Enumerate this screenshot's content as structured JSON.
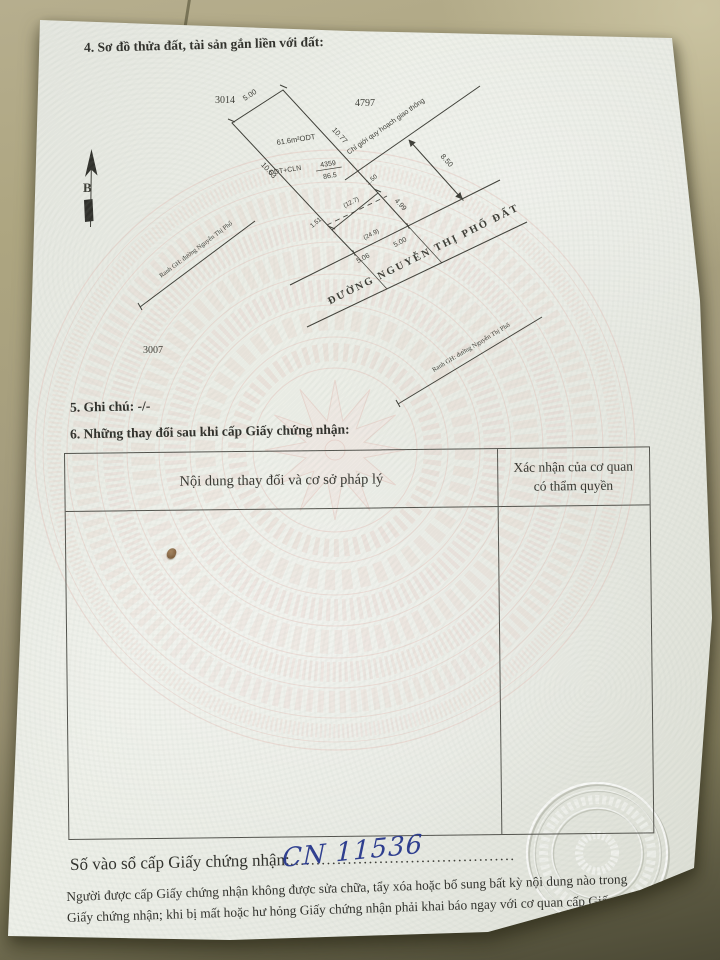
{
  "document": {
    "section4_title": "4. Sơ đồ thửa đất, tài sản gắn liền với đất:",
    "section5_title": "5. Ghi chú: -/-",
    "section6_title": "6. Những thay đổi sau khi cấp Giấy chứng nhận:",
    "table": {
      "col1_header": "Nội dung thay đổi và cơ sở pháp lý",
      "col2_header_line1": "Xác nhận của cơ quan",
      "col2_header_line2": "có thẩm quyền"
    },
    "registry": {
      "label": "Số vào sổ cấp Giấy chứng nhận:",
      "dots": "...........................................",
      "number": "CN 11536"
    },
    "footer_line1": "Người được cấp Giấy chứng nhận không được sửa chữa, tẩy xóa hoặc bổ sung bất kỳ nội dung nào trong",
    "footer_line2": "Giấy chứng nhận; khi bị mất hoặc hư hỏng Giấy chứng nhận phải khai báo ngay với cơ quan cấp Giấy."
  },
  "diagram": {
    "north_label": "B",
    "parcel_top_left": "3014",
    "parcel_top_right": "4797",
    "parcel_bottom_left": "3007",
    "area_label": "61.6m²ODT",
    "use_label": "ODT+CLN",
    "plot_number": "4359",
    "plot_area": "86.5",
    "edge_top": "5.00",
    "edge_right": "10.77",
    "edge_left": "10.63",
    "seg_150": "1.50",
    "seg_151": "1.51",
    "seg_499": "4.99",
    "planning_label": "Chỉ giới quy hoạch giao thông",
    "planning_width": "8.50",
    "dashed_127": "(12.7)",
    "dashed_249": "(24.9)",
    "frontage_506": "5.06",
    "frontage_500": "5.00",
    "road_name": "ĐƯỜNG NGUYỄN THỊ PHỐ ĐẤT",
    "boundary_left": "Ranh GH: đường Nguyễn Thị Phố",
    "boundary_right": "Ranh GH: đường Nguyễn Thị Phố"
  },
  "colors": {
    "ink": "#2e2e29",
    "handwriting_blue": "#2a3a8e",
    "watermark_pink": "#e8c4bc",
    "paper": "#e9ebe4",
    "desk": "#a49c7d"
  }
}
